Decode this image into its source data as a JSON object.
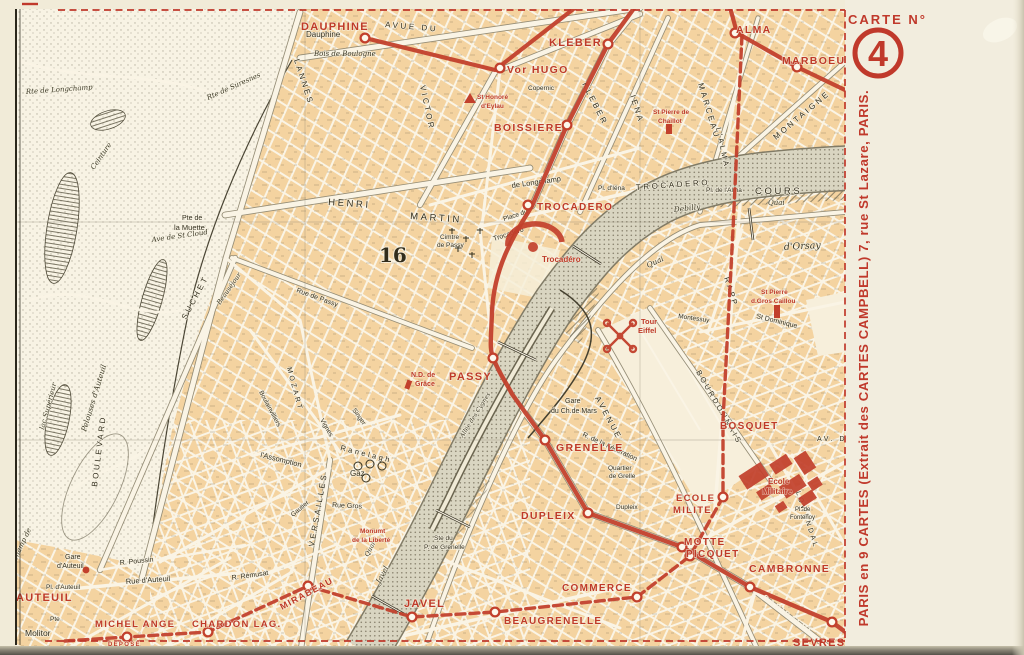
{
  "postcard": {
    "margin": {
      "carte_label": "CARTE N°",
      "carte_number": "4",
      "publisher": "PARIS en 9 CARTES (Extrait des CARTES CAMPBELL) 7, rue St Lazare, PARIS.",
      "depose": "DEPOSE"
    },
    "colors": {
      "red": "#c2402c",
      "paper": "#f1ebd8",
      "map_cream": "#faf4e5",
      "block_tan": "#f4d3a0",
      "seine": "#d9d5c1",
      "ink": "#34301f"
    },
    "map": {
      "arrondissement_label": "16",
      "stations": [
        {
          "t": "DAUPHINE",
          "x": 301,
          "y": 30,
          "s": 11
        },
        {
          "t": "KLEBER",
          "x": 549,
          "y": 46,
          "s": 11
        },
        {
          "t": "Vor HUGO",
          "x": 507,
          "y": 73,
          "s": 10.5
        },
        {
          "t": "BOISSIERE",
          "x": 494,
          "y": 131,
          "s": 10.5
        },
        {
          "t": "TROCADERO",
          "x": 537,
          "y": 210,
          "s": 10
        },
        {
          "t": "ALMA",
          "x": 736,
          "y": 33,
          "s": 10.5
        },
        {
          "t": "MARBOEUF",
          "x": 782,
          "y": 64,
          "s": 10.5
        },
        {
          "t": "PASSY",
          "x": 449,
          "y": 380,
          "s": 11
        },
        {
          "t": "GRENELLE",
          "x": 556,
          "y": 451,
          "s": 10.5
        },
        {
          "t": "DUPLEIX",
          "x": 521,
          "y": 519,
          "s": 10.5
        },
        {
          "t": "COMMERCE",
          "x": 562,
          "y": 591,
          "s": 10
        },
        {
          "t": "JAVEL",
          "x": 404,
          "y": 607,
          "s": 11
        },
        {
          "t": "BEAUGRENELLE",
          "x": 504,
          "y": 624,
          "s": 10
        },
        {
          "t": "MOTTE",
          "x": 684,
          "y": 545,
          "s": 10
        },
        {
          "t": "PICQUET",
          "x": 686,
          "y": 557,
          "s": 10
        },
        {
          "t": "ECOLE",
          "x": 676,
          "y": 501,
          "s": 9.5
        },
        {
          "t": "MILITE",
          "x": 673,
          "y": 513,
          "s": 9.5
        },
        {
          "t": "CAMBRONNE",
          "x": 749,
          "y": 572,
          "s": 10.5
        },
        {
          "t": "SEVRES",
          "x": 793,
          "y": 646,
          "s": 11
        },
        {
          "t": "BOSQUET",
          "x": 720,
          "y": 429,
          "s": 10
        },
        {
          "t": "AUTEUIL",
          "x": 16,
          "y": 601,
          "s": 11
        },
        {
          "t": "MICHEL ANGE",
          "x": 95,
          "y": 627,
          "s": 9.5
        },
        {
          "t": "CHARDON LAG.",
          "x": 192,
          "y": 627,
          "s": 9.5
        },
        {
          "t": "MIRABEAU",
          "x": 282,
          "y": 610,
          "s": 9,
          "r": -28
        }
      ],
      "landmarks": [
        {
          "t": "Trocadéro",
          "x": 542,
          "y": 262,
          "s": 8
        },
        {
          "t": "Tour",
          "x": 641,
          "y": 324,
          "s": 7.5
        },
        {
          "t": "Eiffel",
          "x": 638,
          "y": 333,
          "s": 7.5
        },
        {
          "t": "Ecole",
          "x": 768,
          "y": 484,
          "s": 8
        },
        {
          "t": "Militaire",
          "x": 762,
          "y": 494,
          "s": 8
        },
        {
          "t": "N.D. de",
          "x": 411,
          "y": 377,
          "s": 7
        },
        {
          "t": "Grâce",
          "x": 415,
          "y": 386,
          "s": 7
        },
        {
          "t": "St Honoré",
          "x": 477,
          "y": 99,
          "s": 6.5
        },
        {
          "t": "d'Eylau",
          "x": 481,
          "y": 108,
          "s": 6.5
        },
        {
          "t": "St Pierre de",
          "x": 653,
          "y": 114,
          "s": 6.5
        },
        {
          "t": "Chaillot",
          "x": 658,
          "y": 123,
          "s": 6.5
        },
        {
          "t": "St Pierre",
          "x": 761,
          "y": 294,
          "s": 6.5
        },
        {
          "t": "d.Gros Caillou",
          "x": 751,
          "y": 303,
          "s": 6.5
        },
        {
          "t": "Monumt",
          "x": 360,
          "y": 533,
          "s": 6.5
        },
        {
          "t": "de la Liberté",
          "x": 352,
          "y": 542,
          "s": 6.5
        }
      ],
      "street_on_line_labels": [
        {
          "t": "GARIBALDI",
          "x": 762,
          "y": 598,
          "s": 7.5,
          "r": 37
        }
      ],
      "black_labels": [
        {
          "t": "Dauphine",
          "x": 306,
          "y": 37,
          "s": 8
        },
        {
          "t": "Bois de Boulogne",
          "x": 314,
          "y": 56,
          "s": 7,
          "c": "i"
        },
        {
          "t": "AVUE DU",
          "x": 385,
          "y": 27,
          "s": 8,
          "r": 5,
          "c": "B"
        },
        {
          "t": "LANNES",
          "x": 294,
          "y": 60,
          "s": 8,
          "r": 72,
          "c": "B"
        },
        {
          "t": "VICTOR",
          "x": 420,
          "y": 86,
          "s": 8,
          "r": 78,
          "c": "B"
        },
        {
          "t": "KLEBER",
          "x": 582,
          "y": 84,
          "s": 8,
          "r": 63,
          "c": "B"
        },
        {
          "t": "Copernic",
          "x": 528,
          "y": 90,
          "s": 6.5
        },
        {
          "t": "IENA",
          "x": 630,
          "y": 96,
          "s": 8,
          "r": 72,
          "c": "B"
        },
        {
          "t": "MARCEAU",
          "x": 698,
          "y": 84,
          "s": 8,
          "r": 73,
          "c": "B"
        },
        {
          "t": "L'ALMA",
          "x": 716,
          "y": 128,
          "s": 7.5,
          "r": 78,
          "c": "B"
        },
        {
          "t": "MONTAIGNE",
          "x": 776,
          "y": 140,
          "s": 8,
          "r": -40,
          "c": "B"
        },
        {
          "t": "de Longchamp",
          "x": 512,
          "y": 188,
          "s": 7.5,
          "r": -8
        },
        {
          "t": "TROCADERO",
          "x": 636,
          "y": 190,
          "s": 8,
          "r": -4,
          "c": "B"
        },
        {
          "t": "COURS",
          "x": 755,
          "y": 194,
          "s": 9.5,
          "c": "B",
          "ls": 5
        },
        {
          "t": "Quai",
          "x": 768,
          "y": 205,
          "s": 7,
          "c": "i"
        },
        {
          "t": "Debilly",
          "x": 674,
          "y": 212,
          "s": 7.5,
          "r": -6,
          "c": "i"
        },
        {
          "t": "d'Orsay",
          "x": 784,
          "y": 250,
          "s": 9.5,
          "r": -3,
          "c": "i"
        },
        {
          "t": "Quai",
          "x": 648,
          "y": 268,
          "s": 7.5,
          "r": -25,
          "c": "i"
        },
        {
          "t": "Pl. d'Iéna",
          "x": 598,
          "y": 190,
          "s": 6.5
        },
        {
          "t": "Pl. de l'Alma",
          "x": 706,
          "y": 192,
          "s": 6.5
        },
        {
          "t": "HENRI",
          "x": 328,
          "y": 205,
          "s": 9.5,
          "r": 4,
          "c": "B",
          "ls": 5
        },
        {
          "t": "MARTIN",
          "x": 410,
          "y": 219,
          "s": 9.5,
          "r": 4,
          "c": "B",
          "ls": 5
        },
        {
          "t": "Pte de",
          "x": 182,
          "y": 220,
          "s": 7
        },
        {
          "t": "la Muette",
          "x": 174,
          "y": 230,
          "s": 7.5
        },
        {
          "t": "Ave de St Cloud",
          "x": 152,
          "y": 242,
          "s": 7,
          "r": -8,
          "c": "i"
        },
        {
          "t": "Cimtre",
          "x": 440,
          "y": 239,
          "s": 6.5
        },
        {
          "t": "de Passy",
          "x": 437,
          "y": 247,
          "s": 6.5
        },
        {
          "t": "16",
          "x": 379,
          "y": 262,
          "s": 20,
          "c": "n"
        },
        {
          "t": "Place du",
          "x": 504,
          "y": 221,
          "s": 6.5,
          "r": -18
        },
        {
          "t": "Trocadéro",
          "x": 494,
          "y": 241,
          "s": 7,
          "r": -18
        },
        {
          "t": "Rte de Longchamp",
          "x": 26,
          "y": 94,
          "s": 7,
          "r": -4,
          "c": "i"
        },
        {
          "t": "Rte de Suresnes",
          "x": 208,
          "y": 100,
          "s": 7,
          "r": -24,
          "c": "i"
        },
        {
          "t": "Ceinture",
          "x": 94,
          "y": 170,
          "s": 7,
          "r": -55,
          "c": "i"
        },
        {
          "t": "lac Supérieur",
          "x": 44,
          "y": 430,
          "s": 7,
          "r": -75,
          "c": "i"
        },
        {
          "t": "Pelouses d'Auteuil",
          "x": 86,
          "y": 432,
          "s": 7.5,
          "r": -73,
          "c": "i"
        },
        {
          "t": "Champ de",
          "x": 16,
          "y": 562,
          "s": 7,
          "r": -65,
          "c": "i"
        },
        {
          "t": "BOULEVARD",
          "x": 97,
          "y": 487,
          "s": 8,
          "r": -83,
          "c": "B"
        },
        {
          "t": "SUCHET",
          "x": 186,
          "y": 320,
          "s": 8,
          "r": -62,
          "c": "B"
        },
        {
          "t": "MOZART",
          "x": 287,
          "y": 368,
          "s": 7,
          "r": 75,
          "c": "B"
        },
        {
          "t": "Rue de Passy",
          "x": 296,
          "y": 292,
          "s": 7,
          "r": 20
        },
        {
          "t": "Ranelagh",
          "x": 340,
          "y": 450,
          "s": 7.5,
          "r": 14,
          "c": "B",
          "ls": 1.5
        },
        {
          "t": "l'Assomption",
          "x": 260,
          "y": 457,
          "s": 7.5,
          "r": 14
        },
        {
          "t": "Rue Gros",
          "x": 332,
          "y": 507,
          "s": 7,
          "r": 3
        },
        {
          "t": "Gautier",
          "x": 293,
          "y": 517,
          "s": 6.5,
          "r": -40
        },
        {
          "t": "VERSAILLES",
          "x": 314,
          "y": 547,
          "s": 8,
          "r": -80,
          "c": "B"
        },
        {
          "t": "Gaz",
          "x": 350,
          "y": 476,
          "s": 8
        },
        {
          "t": "R. Poussin",
          "x": 120,
          "y": 565,
          "s": 7,
          "r": -6
        },
        {
          "t": "Rue d'Auteuil",
          "x": 126,
          "y": 584,
          "s": 7.5,
          "r": -4
        },
        {
          "t": "R. Rémusat",
          "x": 232,
          "y": 580,
          "s": 7,
          "r": -8
        },
        {
          "t": "Gare",
          "x": 65,
          "y": 559,
          "s": 7
        },
        {
          "t": "d'Auteuil",
          "x": 57,
          "y": 568,
          "s": 7
        },
        {
          "t": "Pl. d'Auteuil",
          "x": 46,
          "y": 589,
          "s": 6.5
        },
        {
          "t": "Pte",
          "x": 50,
          "y": 621,
          "s": 6.5
        },
        {
          "t": "Molitor",
          "x": 25,
          "y": 636,
          "s": 8.5
        },
        {
          "t": "Ste du",
          "x": 434,
          "y": 540,
          "s": 6.5
        },
        {
          "t": "P. de Grenelle",
          "x": 424,
          "y": 549,
          "s": 6.5
        },
        {
          "t": "Quai",
          "x": 368,
          "y": 557,
          "s": 6.5,
          "r": -62,
          "c": "i"
        },
        {
          "t": "Javel",
          "x": 380,
          "y": 584,
          "s": 7.5,
          "r": -62,
          "c": "i"
        },
        {
          "t": "Allée des Cygnes",
          "x": 463,
          "y": 438,
          "s": 6,
          "r": -58,
          "c": "i"
        },
        {
          "t": "Gare",
          "x": 565,
          "y": 403,
          "s": 7
        },
        {
          "t": "du Ch.de Mars",
          "x": 551,
          "y": 413,
          "s": 7
        },
        {
          "t": "R. de la Fédération",
          "x": 582,
          "y": 436,
          "s": 7,
          "r": 25
        },
        {
          "t": "Quartier",
          "x": 608,
          "y": 470,
          "s": 6.5
        },
        {
          "t": "de Grelle",
          "x": 609,
          "y": 478,
          "s": 6.5
        },
        {
          "t": "AVENUE",
          "x": 595,
          "y": 398,
          "s": 8,
          "r": 62,
          "c": "B"
        },
        {
          "t": "BOURDONNAIS",
          "x": 696,
          "y": 372,
          "s": 7.5,
          "r": 60,
          "c": "B"
        },
        {
          "t": "RAPP",
          "x": 724,
          "y": 278,
          "s": 7.5,
          "r": 72,
          "c": "B"
        },
        {
          "t": "St Dominique",
          "x": 756,
          "y": 318,
          "s": 7,
          "r": 14
        },
        {
          "t": "Montessuy",
          "x": 678,
          "y": 318,
          "s": 6.5,
          "r": 8
        },
        {
          "t": "LOWENDAL",
          "x": 796,
          "y": 492,
          "s": 7,
          "r": 72,
          "c": "B"
        },
        {
          "t": "AV. DE",
          "x": 817,
          "y": 441,
          "s": 7,
          "c": "B"
        },
        {
          "t": "Pl. de",
          "x": 795,
          "y": 511,
          "s": 6
        },
        {
          "t": "Fontenoy",
          "x": 790,
          "y": 519,
          "s": 6
        },
        {
          "t": "Dupleix",
          "x": 616,
          "y": 509,
          "s": 6.5
        },
        {
          "t": "Boulainvilliers",
          "x": 259,
          "y": 392,
          "s": 6.5,
          "r": 62
        },
        {
          "t": "Beauséjour",
          "x": 220,
          "y": 305,
          "s": 6.5,
          "r": -55,
          "c": "i"
        },
        {
          "t": "Singer",
          "x": 352,
          "y": 410,
          "s": 6.5,
          "r": 55
        },
        {
          "t": "Vignes",
          "x": 320,
          "y": 420,
          "s": 6.5,
          "r": 60
        }
      ],
      "station_circles": {
        "solid": [
          [
            365,
            38
          ],
          [
            500,
            68
          ],
          [
            608,
            44
          ],
          [
            567,
            125
          ],
          [
            528,
            205
          ],
          [
            493,
            358
          ],
          [
            545,
            440
          ],
          [
            588,
            513
          ],
          [
            682,
            547
          ],
          [
            750,
            587
          ],
          [
            832,
            622
          ],
          [
            735,
            33
          ],
          [
            797,
            67
          ]
        ],
        "dashed": [
          [
            723,
            497
          ],
          [
            690,
            556
          ],
          [
            637,
            597
          ],
          [
            495,
            612
          ],
          [
            412,
            617
          ],
          [
            308,
            586
          ],
          [
            208,
            632
          ],
          [
            127,
            637
          ]
        ],
        "filled": [
          [
            86,
            570
          ]
        ]
      }
    }
  }
}
